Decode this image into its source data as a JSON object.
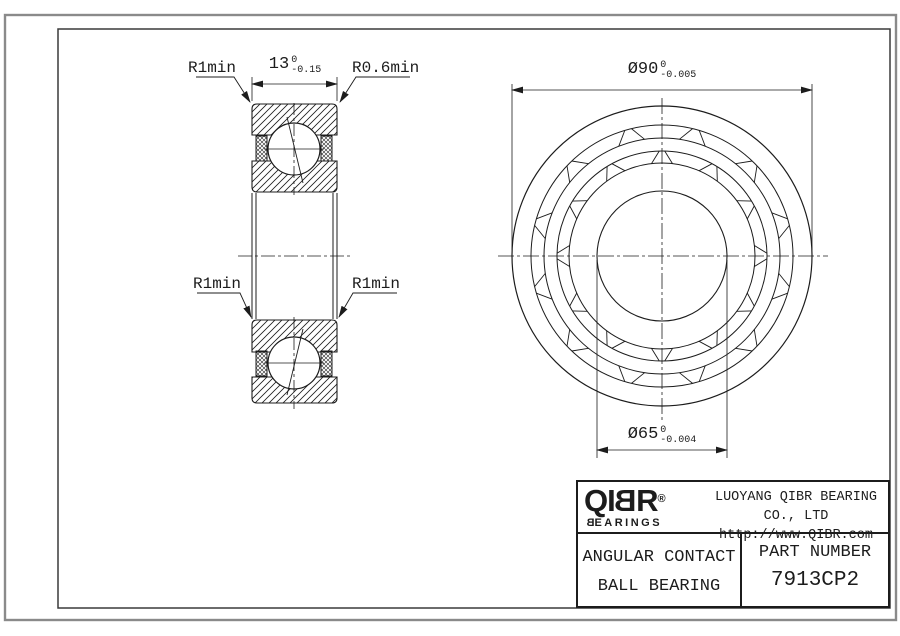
{
  "section_view": {
    "labels": {
      "top_left": "R1min",
      "top_right": "R0.6min",
      "mid_left": "R1min",
      "mid_right": "R1min"
    },
    "width_dim": {
      "value": "13",
      "tol_upper": "0",
      "tol_lower": "-0.15"
    }
  },
  "front_view": {
    "outer_dim": {
      "value": "Ø90",
      "tol_upper": "0",
      "tol_lower": "-0.005"
    },
    "bore_dim": {
      "value": "Ø65",
      "tol_upper": "0",
      "tol_lower": "-0.004"
    }
  },
  "title_block": {
    "logo": {
      "part1": "QI",
      "mirrored": "B",
      "part2": "R",
      "registered": "®",
      "sub_mirrored": "B",
      "sub_rest": "EARINGS"
    },
    "company": "LUOYANG QIBR BEARING CO., LTD",
    "website": "http://www.QIBR.com",
    "product_line1": "ANGULAR CONTACT",
    "product_line2": "BALL BEARING",
    "part_number_label": "PART NUMBER",
    "part_number": "7913CP2"
  },
  "colors": {
    "line": "#1c1c1c",
    "background": "#ffffff",
    "outer_border": "#8a8a8a"
  }
}
